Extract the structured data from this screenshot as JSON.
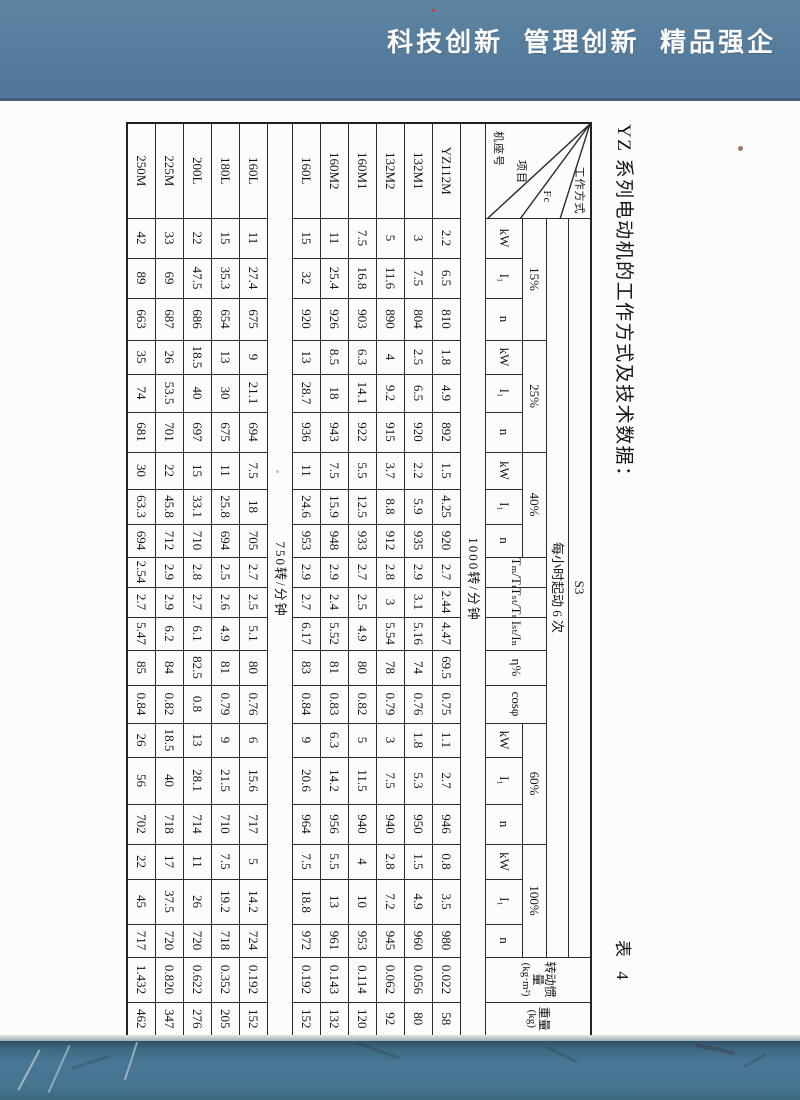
{
  "page": {
    "banner": "科技创新  管理创新  精品强企",
    "title": "YZ 系列电动机的工作方式及技术数据：",
    "caption": "表 4"
  },
  "colors": {
    "banner_bg": "#567c9c",
    "footer_bg": "#487896",
    "paper": "#fcfcfa",
    "table_line": "#2b2b2b"
  },
  "table": {
    "corner": {
      "duty": "工作方式",
      "fc": "Fc",
      "item": "项目",
      "frame": "机座号"
    },
    "s3": "S3",
    "starts_per_hour": "每小时起动 6 次",
    "duty_groups": [
      "15%",
      "25%",
      "40%",
      "60%",
      "100%"
    ],
    "sub_cols": [
      "kW",
      "I₁",
      "n"
    ],
    "ratio_cols": [
      "Tₘ/Tₙ",
      "Tₛₜ/Tₙ",
      "Iₛₜ/Iₙ",
      "η%",
      "cosφ"
    ],
    "inertia": {
      "title": "转动惯量",
      "unit": "(kg·m²)"
    },
    "weight": {
      "title": "重量",
      "unit": "(kg)"
    },
    "sections": [
      {
        "label": "1000转/分钟",
        "rows": [
          {
            "model": "YZ112M",
            "values": [
              "2.2",
              "6.5",
              "810",
              "1.8",
              "4.9",
              "892",
              "1.5",
              "4.25",
              "920",
              "2.7",
              "2.44",
              "4.47",
              "69.5",
              "0.75",
              "1.1",
              "2.7",
              "946",
              "0.8",
              "3.5",
              "980",
              "0.022",
              "58"
            ]
          },
          {
            "model": "132M1",
            "values": [
              "3",
              "7.5",
              "804",
              "2.5",
              "6.5",
              "920",
              "2.2",
              "5.9",
              "935",
              "2.9",
              "3.1",
              "5.16",
              "74",
              "0.76",
              "1.8",
              "5.3",
              "950",
              "1.5",
              "4.9",
              "960",
              "0.056",
              "80"
            ]
          },
          {
            "model": "132M2",
            "values": [
              "5",
              "11.6",
              "890",
              "4",
              "9.2",
              "915",
              "3.7",
              "8.8",
              "912",
              "2.8",
              "3",
              "5.54",
              "78",
              "0.79",
              "3",
              "7.5",
              "940",
              "2.8",
              "7.2",
              "945",
              "0.062",
              "92"
            ]
          },
          {
            "model": "160M1",
            "values": [
              "7.5",
              "16.8",
              "903",
              "6.3",
              "14.1",
              "922",
              "5.5",
              "12.5",
              "933",
              "2.7",
              "2.5",
              "4.9",
              "80",
              "0.82",
              "5",
              "11.5",
              "940",
              "4",
              "10",
              "953",
              "0.114",
              "120"
            ]
          },
          {
            "model": "160M2",
            "values": [
              "11",
              "25.4",
              "926",
              "8.5",
              "18",
              "943",
              "7.5",
              "15.9",
              "948",
              "2.9",
              "2.4",
              "5.52",
              "81",
              "0.83",
              "6.3",
              "14.2",
              "956",
              "5.5",
              "13",
              "961",
              "0.143",
              "132"
            ]
          },
          {
            "model": "160L",
            "values": [
              "15",
              "32",
              "920",
              "13",
              "28.7",
              "936",
              "11",
              "24.6",
              "953",
              "2.9",
              "2.7",
              "6.17",
              "83",
              "0.84",
              "9",
              "20.6",
              "964",
              "7.5",
              "18.8",
              "972",
              "0.192",
              "152"
            ]
          }
        ]
      },
      {
        "label": "750转/分钟",
        "rows": [
          {
            "model": "160L",
            "values": [
              "11",
              "27.4",
              "675",
              "9",
              "21.1",
              "694",
              "7.5",
              "18",
              "705",
              "2.7",
              "2.5",
              "5.1",
              "80",
              "0.76",
              "6",
              "15.6",
              "717",
              "5",
              "14.2",
              "724",
              "0.192",
              "152"
            ]
          },
          {
            "model": "180L",
            "values": [
              "15",
              "35.3",
              "654",
              "13",
              "30",
              "675",
              "11",
              "25.8",
              "694",
              "2.5",
              "2.6",
              "4.9",
              "81",
              "0.79",
              "9",
              "21.5",
              "710",
              "7.5",
              "19.2",
              "718",
              "0.352",
              "205"
            ]
          },
          {
            "model": "200L",
            "values": [
              "22",
              "47.5",
              "686",
              "18.5",
              "40",
              "697",
              "15",
              "33.1",
              "710",
              "2.8",
              "2.7",
              "6.1",
              "82.5",
              "0.8",
              "13",
              "28.1",
              "714",
              "11",
              "26",
              "720",
              "0.622",
              "276"
            ]
          },
          {
            "model": "225M",
            "values": [
              "33",
              "69",
              "687",
              "26",
              "53.5",
              "701",
              "22",
              "45.8",
              "712",
              "2.9",
              "2.9",
              "6.2",
              "84",
              "0.82",
              "18.5",
              "40",
              "718",
              "17",
              "37.5",
              "720",
              "0.820",
              "347"
            ]
          },
          {
            "model": "250M",
            "values": [
              "42",
              "89",
              "663",
              "35",
              "74",
              "681",
              "30",
              "63.3",
              "694",
              "2.54",
              "2.7",
              "5.47",
              "85",
              "0.84",
              "26",
              "56",
              "702",
              "22",
              "45",
              "717",
              "1.432",
              "462"
            ]
          }
        ]
      }
    ]
  }
}
